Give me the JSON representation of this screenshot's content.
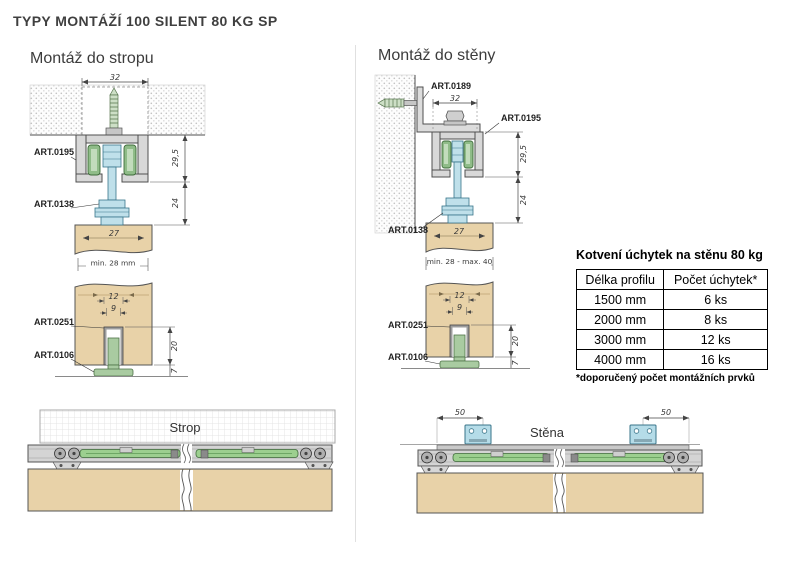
{
  "title": "TYPY MONTÁŽÍ 100 SILENT 80 KG SP",
  "ceiling_section": {
    "heading": "Montáž do stropu",
    "cross": {
      "dim_top_width": "32",
      "art_track": "ART.0195",
      "art_hanger": "ART.0138",
      "dim_track_height": "29,5",
      "dim_hanger_drop": "24",
      "dim_door_thickness": "27",
      "dim_door_min": "min. 28 mm",
      "dim_groove_outer": "12",
      "dim_groove_inner": "9",
      "art_channel": "ART.0251",
      "art_floor_guide": "ART.0106",
      "dim_groove_depth": "20",
      "dim_guide_height": "7"
    },
    "side": {
      "label": "Strop"
    }
  },
  "wall_section": {
    "heading": "Montáž do stěny",
    "cross": {
      "art_bracket": "ART.0189",
      "dim_top_width": "32",
      "art_track": "ART.0195",
      "art_hanger": "ART.0138",
      "dim_track_height": "29,5",
      "dim_hanger_drop": "24",
      "dim_door_thickness": "27",
      "dim_door_range": "min. 28 - max. 40",
      "dim_groove_outer": "12",
      "dim_groove_inner": "9",
      "art_channel": "ART.0251",
      "art_floor_guide": "ART.0106",
      "dim_groove_depth": "20",
      "dim_guide_height": "7"
    },
    "side": {
      "label": "Stěna",
      "dim_left": "50",
      "dim_right": "50"
    }
  },
  "anchor_table": {
    "title": "Kotvení úchytek na stěnu 80 kg",
    "headers": [
      "Délka profilu",
      "Počet úchytek*"
    ],
    "rows": [
      [
        "1500 mm",
        "6 ks"
      ],
      [
        "2000 mm",
        "8 ks"
      ],
      [
        "3000 mm",
        "12 ks"
      ],
      [
        "4000 mm",
        "16 ks"
      ]
    ],
    "footnote": "*doporučený počet montážních prvků"
  },
  "colors": {
    "door_wood": "#e8d2a8",
    "roller_green": "#8fbc88",
    "damper_green": "#9ccf8f",
    "hanger_blue": "#bfe0ea",
    "bracket_blue": "#b5dce8",
    "track_gray": "#d8d8d8",
    "outline": "#4f4f4f",
    "text": "#3d3d3d"
  }
}
